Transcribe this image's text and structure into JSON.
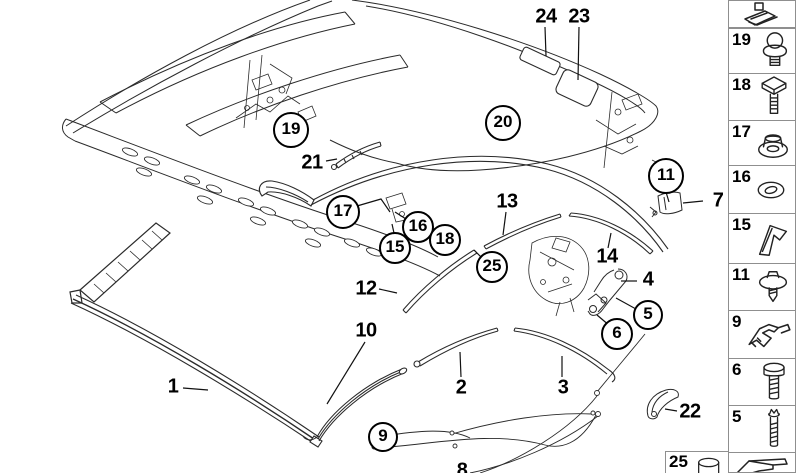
{
  "diagram": {
    "description": "convertible roof seal and trim mouldings exploded parts diagram",
    "callouts": [
      {
        "label": "24",
        "x": 546,
        "y": 17,
        "circled": false
      },
      {
        "label": "23",
        "x": 579,
        "y": 17,
        "circled": false
      },
      {
        "label": "19",
        "x": 291,
        "y": 130,
        "circled": true,
        "r": 16
      },
      {
        "label": "21",
        "x": 312,
        "y": 163,
        "circled": false
      },
      {
        "label": "20",
        "x": 503,
        "y": 123,
        "circled": true,
        "r": 16
      },
      {
        "label": "11",
        "x": 666,
        "y": 176,
        "circled": true,
        "r": 16
      },
      {
        "label": "7",
        "x": 718,
        "y": 201,
        "circled": false
      },
      {
        "label": "17",
        "x": 343,
        "y": 212,
        "circled": true,
        "r": 15
      },
      {
        "label": "13",
        "x": 507,
        "y": 202,
        "circled": false
      },
      {
        "label": "16",
        "x": 418,
        "y": 227,
        "circled": true,
        "r": 14
      },
      {
        "label": "18",
        "x": 445,
        "y": 240,
        "circled": true,
        "r": 14
      },
      {
        "label": "15",
        "x": 395,
        "y": 248,
        "circled": true,
        "r": 14
      },
      {
        "label": "25",
        "x": 492,
        "y": 267,
        "circled": true,
        "r": 14
      },
      {
        "label": "14",
        "x": 607,
        "y": 257,
        "circled": false
      },
      {
        "label": "12",
        "x": 366,
        "y": 289,
        "circled": false
      },
      {
        "label": "4",
        "x": 648,
        "y": 280,
        "circled": false
      },
      {
        "label": "5",
        "x": 648,
        "y": 315,
        "circled": true,
        "r": 13
      },
      {
        "label": "6",
        "x": 617,
        "y": 334,
        "circled": true,
        "r": 14
      },
      {
        "label": "10",
        "x": 366,
        "y": 331,
        "circled": false
      },
      {
        "label": "1",
        "x": 173,
        "y": 387,
        "circled": false
      },
      {
        "label": "2",
        "x": 461,
        "y": 388,
        "circled": false
      },
      {
        "label": "3",
        "x": 563,
        "y": 388,
        "circled": false
      },
      {
        "label": "9",
        "x": 383,
        "y": 437,
        "circled": true,
        "r": 13
      },
      {
        "label": "22",
        "x": 690,
        "y": 412,
        "circled": false
      },
      {
        "label": "8",
        "x": 462,
        "y": 471,
        "circled": false
      }
    ]
  },
  "legend": {
    "items": [
      {
        "label": "",
        "icon": "roof-clip"
      },
      {
        "label": "19",
        "icon": "ball-stud"
      },
      {
        "label": "18",
        "icon": "square-head-bolt"
      },
      {
        "label": "17",
        "icon": "flange-nut"
      },
      {
        "label": "16",
        "icon": "washer"
      },
      {
        "label": "15",
        "icon": "clamp-plate"
      },
      {
        "label": "11",
        "icon": "washer-head-screw"
      },
      {
        "label": "9",
        "icon": "retainer-bracket"
      },
      {
        "label": "6",
        "icon": "hex-bolt"
      },
      {
        "label": "5",
        "icon": "threaded-stud"
      },
      {
        "label": "",
        "icon": "z-clip"
      }
    ],
    "grease_item": {
      "label": "25",
      "icon": "grease-tube"
    }
  },
  "colors": {
    "background": "#ffffff",
    "line": "#2b2b2b",
    "legend_border": "#8f8f8f",
    "text": "#000000"
  }
}
